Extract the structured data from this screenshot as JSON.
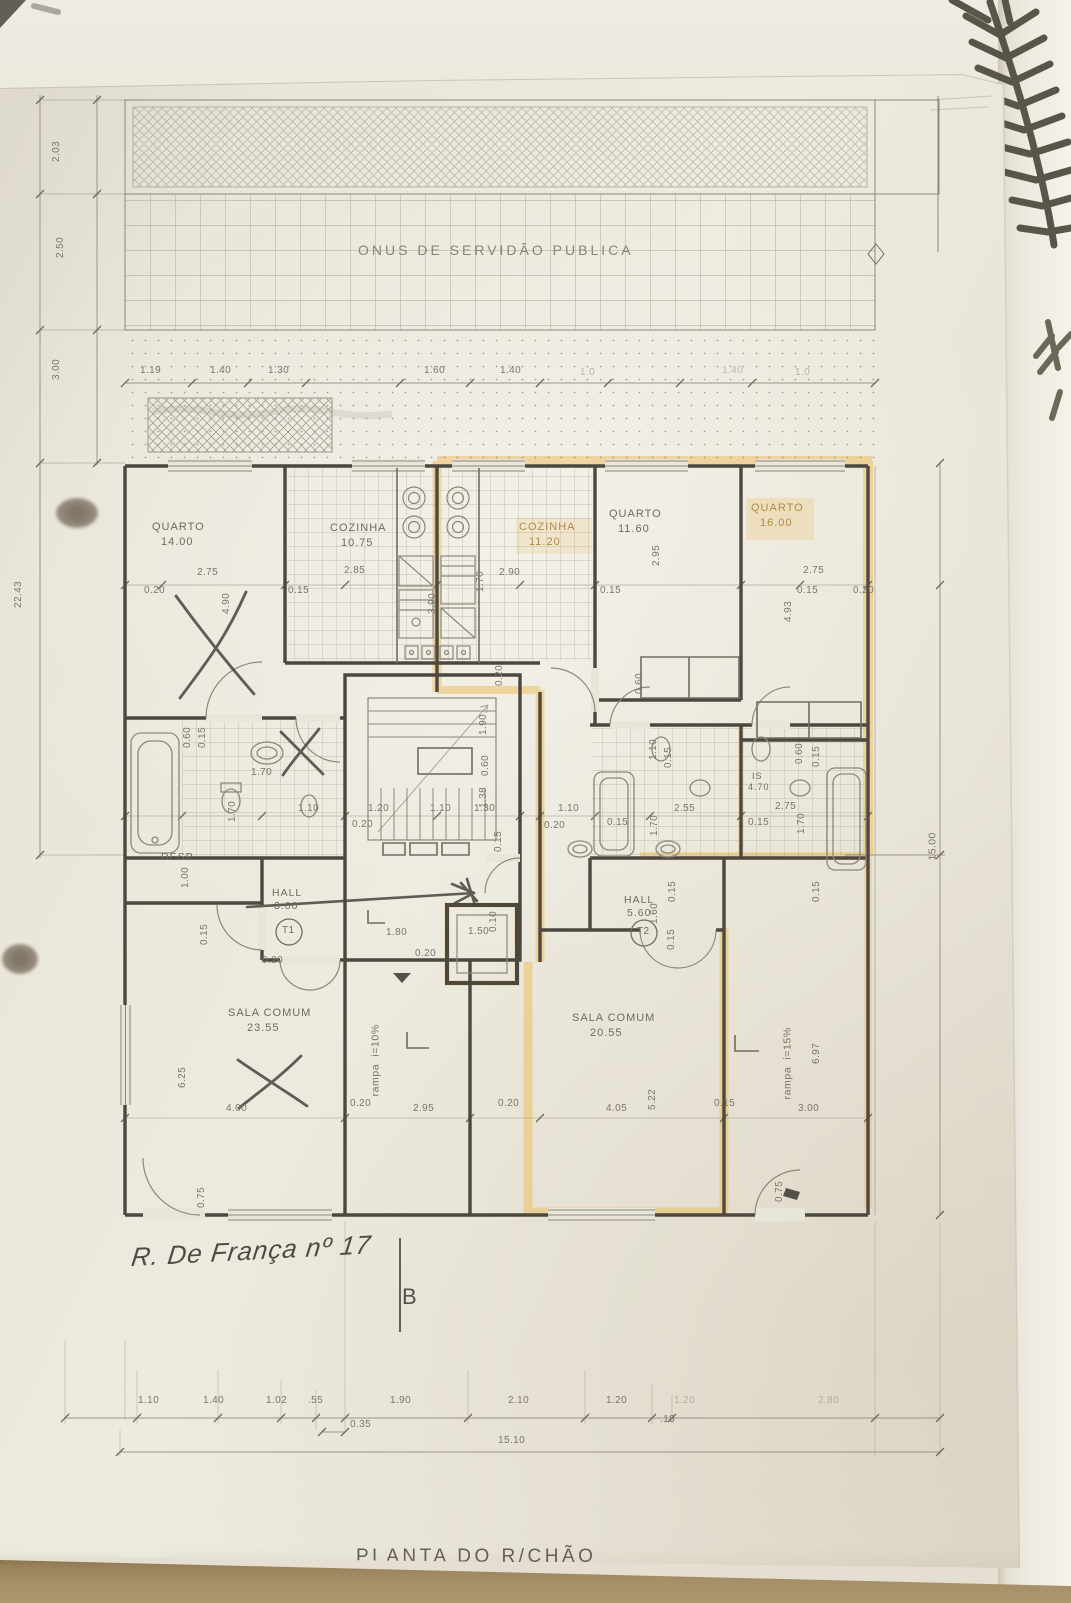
{
  "colors": {
    "paper": "#e9e5d9",
    "pencil": "#6f6a5e",
    "wall_line": "#4c473f",
    "highlight": "#eec167",
    "table": "#a08a64",
    "fern": "#4b4a3d"
  },
  "plan": {
    "title": "PLANTA DO R/CHÃO",
    "servitude_band": "ONUS DE SERVIDÃO PUBLICA",
    "handwriting": {
      "street": "R. De França nº 17",
      "section_letter": "B"
    },
    "apartments": [
      "T1",
      "T2"
    ],
    "rooms": [
      {
        "name": "QUARTO",
        "area_m2": "14.00"
      },
      {
        "name": "COZINHA",
        "area_m2": "10.75"
      },
      {
        "name": "COZINHA",
        "area_m2": "11.20"
      },
      {
        "name": "QUARTO",
        "area_m2": "11.60"
      },
      {
        "name": "QUARTO",
        "area_m2": "16.00"
      },
      {
        "name": "DESP"
      },
      {
        "name": "HALL",
        "area_m2": "3.00",
        "apartment": "T1"
      },
      {
        "name": "HALL",
        "area_m2": "5.60",
        "apartment": "T2"
      },
      {
        "name": "SALA COMUM",
        "area_m2": "23.55"
      },
      {
        "name": "SALA COMUM",
        "area_m2": "20.55"
      },
      {
        "name": "IS",
        "area_m2": "4.70"
      }
    ],
    "ramps": [
      "rampa  i=10%",
      "rampa  i=15%"
    ],
    "overall_dims": {
      "bottom_total": "15.10",
      "left_total": "22.43",
      "right_total": "15.00"
    },
    "labels": [
      {
        "t": "ONUS DE SERVIDÃO PUBLICA",
        "x": 358,
        "y": 243,
        "s": 14,
        "k": "zone",
        "n": "servitude-zone-label"
      },
      {
        "t": "1.19",
        "x": 140,
        "y": 366,
        "k": "dim"
      },
      {
        "t": "1.40",
        "x": 210,
        "y": 366,
        "k": "dim"
      },
      {
        "t": "1.30",
        "x": 268,
        "y": 366,
        "k": "dim"
      },
      {
        "t": "1.60",
        "x": 424,
        "y": 366,
        "k": "dim"
      },
      {
        "t": "1.40",
        "x": 500,
        "y": 366,
        "k": "dim"
      },
      {
        "t": "1.0",
        "x": 580,
        "y": 368,
        "k": "dim",
        "c": "faint"
      },
      {
        "t": "1.40",
        "x": 722,
        "y": 366,
        "k": "dim",
        "c": "faint"
      },
      {
        "t": "1.0",
        "x": 795,
        "y": 368,
        "k": "dim",
        "c": "faint"
      },
      {
        "t": "2.03",
        "x": 62,
        "y": 162,
        "r": -90,
        "k": "dim"
      },
      {
        "t": "2.50",
        "x": 66,
        "y": 258,
        "r": -90,
        "k": "dim"
      },
      {
        "t": "3.00",
        "x": 62,
        "y": 380,
        "r": -90,
        "k": "dim"
      },
      {
        "t": "22.43",
        "x": 24,
        "y": 608,
        "r": -90,
        "k": "dim"
      },
      {
        "t": "0.20",
        "x": 144,
        "y": 586,
        "k": "dim"
      },
      {
        "t": "2.75",
        "x": 197,
        "y": 568,
        "k": "dim"
      },
      {
        "t": "4.90",
        "x": 232,
        "y": 614,
        "r": -90,
        "k": "dim"
      },
      {
        "t": "0.15",
        "x": 288,
        "y": 586,
        "k": "dim"
      },
      {
        "t": "2.85",
        "x": 344,
        "y": 566,
        "k": "dim"
      },
      {
        "t": "3.90",
        "x": 438,
        "y": 614,
        "r": -90,
        "k": "dim"
      },
      {
        "t": "1.70",
        "x": 486,
        "y": 592,
        "r": -90,
        "k": "dim"
      },
      {
        "t": "2.90",
        "x": 499,
        "y": 568,
        "k": "dim"
      },
      {
        "t": "0.15",
        "x": 600,
        "y": 586,
        "k": "dim"
      },
      {
        "t": "2.95",
        "x": 662,
        "y": 566,
        "r": -90,
        "k": "dim"
      },
      {
        "t": "0.15",
        "x": 797,
        "y": 586,
        "k": "dim"
      },
      {
        "t": "2.75",
        "x": 803,
        "y": 566,
        "k": "dim"
      },
      {
        "t": "0.20",
        "x": 853,
        "y": 586,
        "k": "dim"
      },
      {
        "t": "4.93",
        "x": 794,
        "y": 622,
        "r": -90,
        "k": "dim"
      },
      {
        "t": "QUARTO",
        "x": 152,
        "y": 522,
        "s": 11,
        "k": "room",
        "n": "room-label-quarto-1"
      },
      {
        "t": "14.00",
        "x": 161,
        "y": 537,
        "s": 11,
        "k": "area"
      },
      {
        "t": "COZINHA",
        "x": 330,
        "y": 523,
        "s": 11,
        "k": "room",
        "n": "room-label-cozinha-1"
      },
      {
        "t": "10.75",
        "x": 341,
        "y": 538,
        "s": 11,
        "k": "area"
      },
      {
        "t": "COZINHA",
        "x": 519,
        "y": 522,
        "s": 11,
        "k": "room",
        "c": "hl",
        "n": "room-label-cozinha-2"
      },
      {
        "t": "11.20",
        "x": 529,
        "y": 537,
        "s": 11,
        "k": "area",
        "c": "hl"
      },
      {
        "t": "QUARTO",
        "x": 609,
        "y": 509,
        "s": 11,
        "k": "room",
        "n": "room-label-quarto-2"
      },
      {
        "t": "11.60",
        "x": 618,
        "y": 524,
        "s": 11,
        "k": "area"
      },
      {
        "t": "QUARTO",
        "x": 751,
        "y": 503,
        "s": 11,
        "k": "room",
        "c": "hl",
        "n": "room-label-quarto-3"
      },
      {
        "t": "16.00",
        "x": 760,
        "y": 518,
        "s": 11,
        "k": "area",
        "c": "hl"
      },
      {
        "t": "DESP",
        "x": 161,
        "y": 852,
        "s": 10.5,
        "k": "room",
        "n": "room-label-desp"
      },
      {
        "t": "HALL",
        "x": 272,
        "y": 888,
        "s": 10.5,
        "k": "room",
        "n": "room-label-hall-t1"
      },
      {
        "t": "3.00",
        "x": 274,
        "y": 901,
        "s": 10.5,
        "k": "area"
      },
      {
        "t": "T1",
        "x": 282,
        "y": 926,
        "s": 10,
        "k": "apt",
        "n": "apartment-t1-badge"
      },
      {
        "t": "HALL",
        "x": 624,
        "y": 895,
        "s": 10.5,
        "k": "room",
        "n": "room-label-hall-t2"
      },
      {
        "t": "5.60",
        "x": 627,
        "y": 908,
        "s": 10.5,
        "k": "area"
      },
      {
        "t": "T2",
        "x": 637,
        "y": 927,
        "s": 10,
        "k": "apt",
        "n": "apartment-t2-badge"
      },
      {
        "t": "SALA COMUM",
        "x": 228,
        "y": 1008,
        "s": 11,
        "k": "room",
        "n": "room-label-sala-1"
      },
      {
        "t": "23.55",
        "x": 247,
        "y": 1023,
        "s": 11,
        "k": "area"
      },
      {
        "t": "SALA COMUM",
        "x": 572,
        "y": 1013,
        "s": 11,
        "k": "room",
        "n": "room-label-sala-2"
      },
      {
        "t": "20.55",
        "x": 590,
        "y": 1028,
        "s": 11,
        "k": "area"
      },
      {
        "t": "IS",
        "x": 752,
        "y": 772,
        "s": 9,
        "k": "room",
        "n": "room-label-is"
      },
      {
        "t": "4.70",
        "x": 748,
        "y": 783,
        "s": 9,
        "k": "area"
      },
      {
        "t": "0.60",
        "x": 193,
        "y": 748,
        "r": -90,
        "k": "dim"
      },
      {
        "t": "0.15",
        "x": 208,
        "y": 748,
        "r": -90,
        "k": "dim"
      },
      {
        "t": "1.70",
        "x": 251,
        "y": 768,
        "k": "dim"
      },
      {
        "t": "1.70",
        "x": 238,
        "y": 822,
        "r": -90,
        "k": "dim"
      },
      {
        "t": "1.10",
        "x": 298,
        "y": 804,
        "k": "dim"
      },
      {
        "t": "1.20",
        "x": 368,
        "y": 804,
        "k": "dim"
      },
      {
        "t": "0.20",
        "x": 352,
        "y": 820,
        "k": "dim"
      },
      {
        "t": "1.10",
        "x": 430,
        "y": 804,
        "k": "dim"
      },
      {
        "t": "1.30",
        "x": 474,
        "y": 804,
        "k": "dim"
      },
      {
        "t": "1.10",
        "x": 558,
        "y": 804,
        "k": "dim"
      },
      {
        "t": "0.20",
        "x": 544,
        "y": 821,
        "k": "dim"
      },
      {
        "t": "0.15",
        "x": 607,
        "y": 818,
        "k": "dim"
      },
      {
        "t": "2.55",
        "x": 674,
        "y": 804,
        "k": "dim"
      },
      {
        "t": "0.15",
        "x": 748,
        "y": 818,
        "k": "dim"
      },
      {
        "t": "2.75",
        "x": 775,
        "y": 802,
        "k": "dim"
      },
      {
        "t": "1.90",
        "x": 489,
        "y": 735,
        "r": -90,
        "k": "dim"
      },
      {
        "t": "0.60",
        "x": 491,
        "y": 776,
        "r": -90,
        "k": "dim"
      },
      {
        "t": "1.38",
        "x": 489,
        "y": 808,
        "r": -90,
        "k": "dim"
      },
      {
        "t": "0.15",
        "x": 504,
        "y": 852,
        "r": -90,
        "k": "dim"
      },
      {
        "t": "0.10",
        "x": 499,
        "y": 932,
        "r": -90,
        "k": "dim"
      },
      {
        "t": "0.20",
        "x": 505,
        "y": 686,
        "r": -90,
        "k": "dim"
      },
      {
        "t": "0.60",
        "x": 645,
        "y": 694,
        "r": -90,
        "k": "dim"
      },
      {
        "t": "1.10",
        "x": 659,
        "y": 760,
        "r": -90,
        "k": "dim"
      },
      {
        "t": "0.15",
        "x": 674,
        "y": 768,
        "r": -90,
        "k": "dim"
      },
      {
        "t": "0.60",
        "x": 805,
        "y": 764,
        "r": -90,
        "k": "dim"
      },
      {
        "t": "0.15",
        "x": 822,
        "y": 767,
        "r": -90,
        "k": "dim"
      },
      {
        "t": "1.70",
        "x": 660,
        "y": 836,
        "r": -90,
        "k": "dim"
      },
      {
        "t": "1.70",
        "x": 807,
        "y": 834,
        "r": -90,
        "k": "dim"
      },
      {
        "t": "1.60",
        "x": 660,
        "y": 924,
        "r": -90,
        "k": "dim"
      },
      {
        "t": "0.15",
        "x": 678,
        "y": 902,
        "r": -90,
        "k": "dim"
      },
      {
        "t": "0.15",
        "x": 677,
        "y": 950,
        "r": -90,
        "k": "dim"
      },
      {
        "t": "0.15",
        "x": 822,
        "y": 902,
        "r": -90,
        "k": "dim"
      },
      {
        "t": "1.80",
        "x": 386,
        "y": 928,
        "k": "dim"
      },
      {
        "t": "0.20",
        "x": 415,
        "y": 949,
        "k": "dim"
      },
      {
        "t": "1.50",
        "x": 468,
        "y": 927,
        "k": "dim"
      },
      {
        "t": "0.15",
        "x": 210,
        "y": 945,
        "r": -90,
        "k": "dim"
      },
      {
        "t": "1.00",
        "x": 191,
        "y": 888,
        "r": -90,
        "k": "dim"
      },
      {
        "t": "0.20",
        "x": 262,
        "y": 956,
        "k": "dim"
      },
      {
        "t": "6.25",
        "x": 188,
        "y": 1088,
        "r": -90,
        "k": "dim"
      },
      {
        "t": "4.00",
        "x": 226,
        "y": 1104,
        "k": "dim"
      },
      {
        "t": "0.75",
        "x": 207,
        "y": 1208,
        "r": -90,
        "k": "dim"
      },
      {
        "t": "0.20",
        "x": 350,
        "y": 1099,
        "k": "dim"
      },
      {
        "t": "2.95",
        "x": 413,
        "y": 1104,
        "k": "dim"
      },
      {
        "t": "0.20",
        "x": 498,
        "y": 1099,
        "k": "dim"
      },
      {
        "t": "4.05",
        "x": 606,
        "y": 1104,
        "k": "dim"
      },
      {
        "t": "5.22",
        "x": 658,
        "y": 1110,
        "r": -90,
        "k": "dim"
      },
      {
        "t": "0.15",
        "x": 714,
        "y": 1099,
        "k": "dim"
      },
      {
        "t": "3.00",
        "x": 798,
        "y": 1104,
        "k": "dim"
      },
      {
        "t": "6.97",
        "x": 822,
        "y": 1064,
        "r": -90,
        "k": "dim"
      },
      {
        "t": "0.75",
        "x": 785,
        "y": 1202,
        "r": -90,
        "k": "dim"
      },
      {
        "t": "rampa  i=10%",
        "x": 381,
        "y": 1096,
        "r": -90,
        "s": 10.5,
        "k": "ramp",
        "n": "ramp-label-10"
      },
      {
        "t": "rampa  i=15%",
        "x": 793,
        "y": 1099,
        "r": -90,
        "s": 10.5,
        "k": "ramp",
        "n": "ramp-label-15"
      },
      {
        "t": "15.00",
        "x": 938,
        "y": 860,
        "r": -90,
        "s": 10.5,
        "k": "dim"
      },
      {
        "t": "1.10",
        "x": 138,
        "y": 1396,
        "k": "dim"
      },
      {
        "t": "1.40",
        "x": 203,
        "y": 1396,
        "k": "dim"
      },
      {
        "t": "1.02",
        "x": 266,
        "y": 1396,
        "k": "dim"
      },
      {
        "t": ".55",
        "x": 308,
        "y": 1396,
        "k": "dim"
      },
      {
        "t": "1.90",
        "x": 390,
        "y": 1396,
        "k": "dim"
      },
      {
        "t": "2.10",
        "x": 508,
        "y": 1396,
        "k": "dim"
      },
      {
        "t": "1.20",
        "x": 606,
        "y": 1396,
        "k": "dim"
      },
      {
        "t": "1.20",
        "x": 674,
        "y": 1396,
        "k": "dim",
        "c": "faint"
      },
      {
        "t": "2.80",
        "x": 818,
        "y": 1396,
        "k": "dim",
        "c": "faint"
      },
      {
        "t": "0.35",
        "x": 350,
        "y": 1420,
        "k": "dim"
      },
      {
        "t": ".18",
        "x": 660,
        "y": 1415,
        "k": "dim"
      },
      {
        "t": "15.10",
        "x": 498,
        "y": 1436,
        "k": "dim"
      },
      {
        "t": "PLANTA DO R/CHÃO",
        "x": 356,
        "y": 1547,
        "s": 19,
        "k": "title",
        "n": "plan-title"
      },
      {
        "t": "R. De França nº 17",
        "x": 130,
        "y": 1244,
        "s": 26,
        "k": "hand",
        "n": "street-annotation"
      },
      {
        "t": "B",
        "x": 402,
        "y": 1286,
        "s": 22,
        "k": "section",
        "n": "section-letter"
      }
    ]
  }
}
